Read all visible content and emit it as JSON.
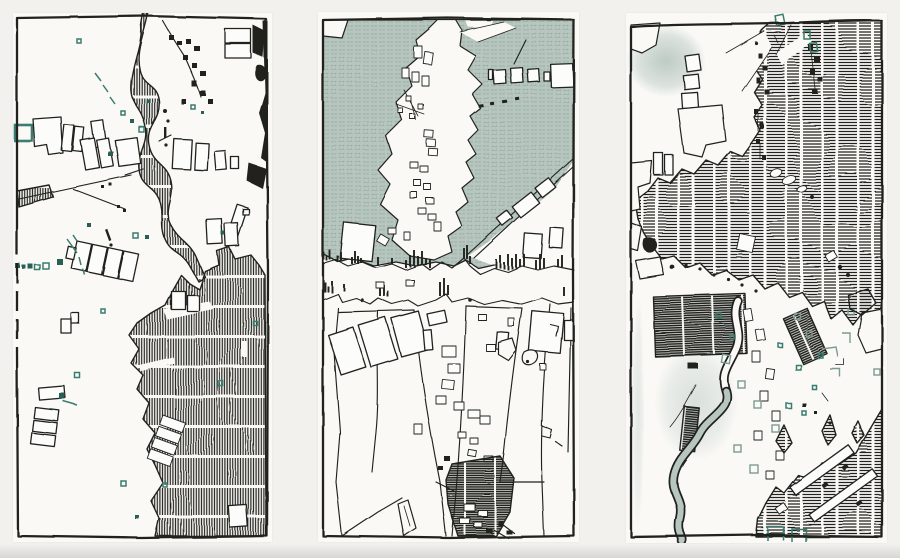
{
  "artwork": {
    "title": "Hand-drawn map triptych",
    "medium": "pen-and-ink map drawings with teal accents",
    "panels": [
      {
        "id": "left",
        "label": "Left panel: map with vertical-hatched river and dark district, outlined buildings, teal marks"
      },
      {
        "id": "center",
        "label": "Center panel: island in teal-shaded water above a line-drawn street grid with pier skyline band and dark hatched patch"
      },
      {
        "id": "right",
        "label": "Right panel: horizontally hatched city, solid dark blocks, winding teal river, hatched harbor with white piers"
      }
    ]
  },
  "colors": {
    "paper": "#f2f1ee",
    "panel_paper": "#faf9f6",
    "ink": "#20231f",
    "teal": "#3b7c70",
    "teal_dark": "#2a5e55",
    "teal_gray": "#7e9991",
    "water": "#b7c6bf",
    "water_line": "#93aba2",
    "shadow": "#d7d6d3",
    "bldg": "#fcfcfa"
  }
}
